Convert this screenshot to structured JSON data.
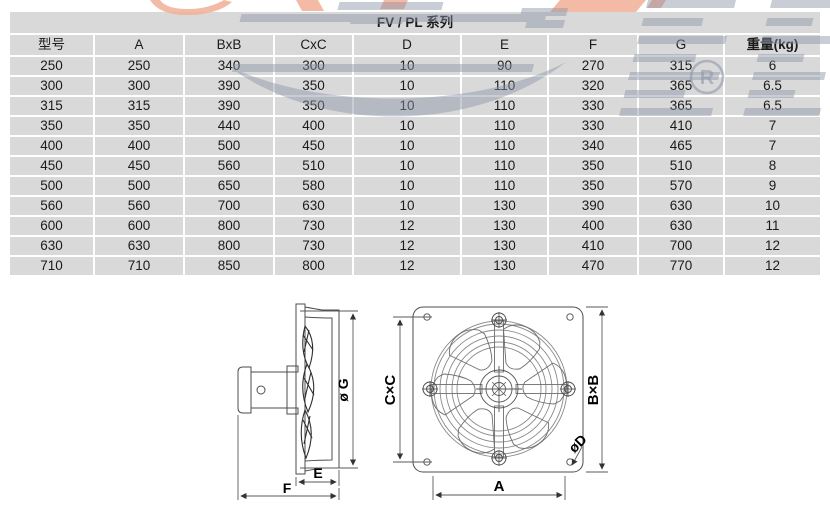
{
  "table": {
    "title": "FV / PL 系列",
    "columns": [
      "型号",
      "A",
      "BxB",
      "CxC",
      "D",
      "E",
      "F",
      "G",
      "重量(kg)"
    ],
    "rows": [
      [
        "250",
        "250",
        "340",
        "300",
        "10",
        "90",
        "270",
        "315",
        "6"
      ],
      [
        "300",
        "300",
        "390",
        "350",
        "10",
        "110",
        "320",
        "365",
        "6.5"
      ],
      [
        "315",
        "315",
        "390",
        "350",
        "10",
        "110",
        "330",
        "365",
        "6.5"
      ],
      [
        "350",
        "350",
        "440",
        "400",
        "10",
        "110",
        "330",
        "410",
        "7"
      ],
      [
        "400",
        "400",
        "500",
        "450",
        "10",
        "110",
        "340",
        "465",
        "7"
      ],
      [
        "450",
        "450",
        "560",
        "510",
        "10",
        "110",
        "350",
        "510",
        "8"
      ],
      [
        "500",
        "500",
        "650",
        "580",
        "10",
        "110",
        "350",
        "570",
        "9"
      ],
      [
        "560",
        "560",
        "700",
        "630",
        "10",
        "130",
        "390",
        "630",
        "10"
      ],
      [
        "600",
        "600",
        "800",
        "730",
        "12",
        "130",
        "400",
        "630",
        "11"
      ],
      [
        "630",
        "630",
        "800",
        "730",
        "12",
        "130",
        "410",
        "700",
        "12"
      ],
      [
        "710",
        "710",
        "850",
        "800",
        "12",
        "130",
        "470",
        "770",
        "12"
      ]
    ]
  },
  "drawing": {
    "side_view": {
      "label_g": "ø G",
      "label_e": "E",
      "label_f": "F"
    },
    "front_view": {
      "label_cxc": "C×C",
      "label_bxb": "B×B",
      "label_a": "A",
      "label_d": "øD"
    }
  },
  "watermark": {
    "registered_letter": "R"
  },
  "colors": {
    "cell_bg": "#d9d9d9",
    "text": "#1b1b1b",
    "drawing_line": "#4d4d4d",
    "watermark_gray": "#8a93a5",
    "watermark_orange": "#f1ae96"
  }
}
